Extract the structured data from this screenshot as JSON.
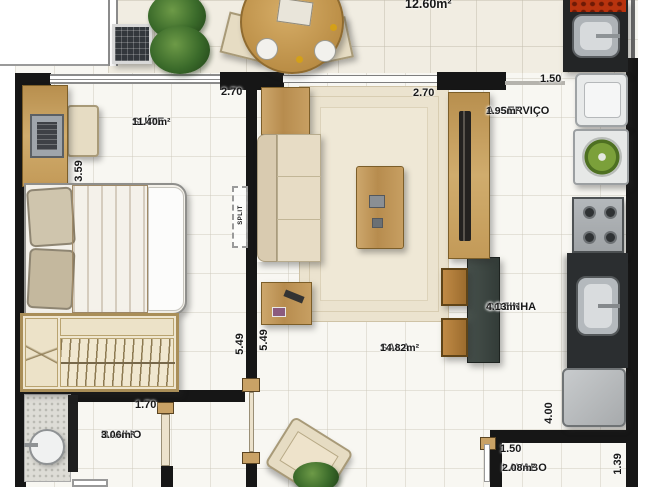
{
  "balcony": {
    "area": "12.60m²"
  },
  "rooms": {
    "suite": {
      "name": "SUÍTE",
      "area": "11.40m²"
    },
    "sala": {
      "name": "SALA",
      "area": "14.82m²"
    },
    "cozinha": {
      "name": "COZINHA",
      "area": "4.13m²"
    },
    "servico": {
      "name": "A. SERVIÇO",
      "area": "1.95m²"
    },
    "banho": {
      "name": "BANHO",
      "area": "3.06m²"
    },
    "lavabo": {
      "name": "LAVABO",
      "area": "2.08m²"
    }
  },
  "dimensions": {
    "suite_width": "2.70",
    "suite_depth": "3.59",
    "suite_length": "5.49",
    "sala_width": "2.70",
    "sala_length": "5.49",
    "servico_width": "1.50",
    "banho_width": "1.70",
    "cozinha_height": "4.00",
    "lavabo_width": "1.50",
    "lavabo_depth": "1.39"
  },
  "annotations": {
    "split_unit": "SPLIT"
  },
  "colors": {
    "wall": "#161616",
    "wood": "#c09a5f",
    "counter_dark": "#2a2d2f",
    "bar_counter": "#3e4844",
    "rug": "#ebe3cf",
    "upholstery": "#e3d8c0",
    "washer_accent": "#7fa33c",
    "grill_accent": "#c64312"
  }
}
